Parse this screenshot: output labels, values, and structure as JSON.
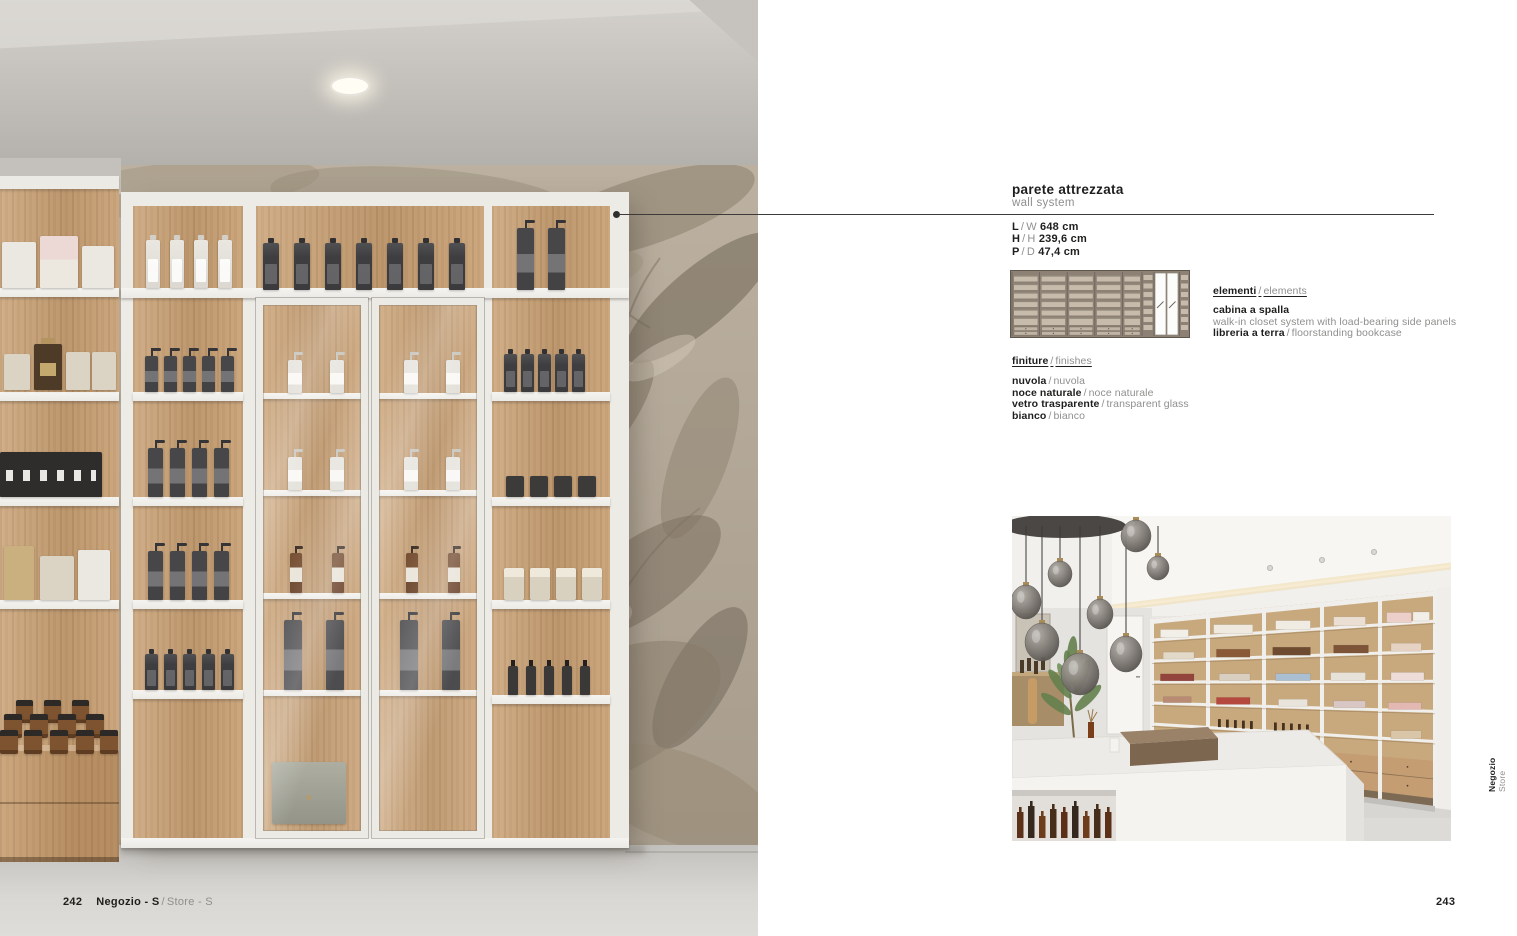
{
  "page": {
    "left_page_number": "242",
    "left_footer_title": "Negozio - S",
    "left_footer_sep": "/",
    "left_footer_subtitle": "Store - S",
    "right_page_number": "243",
    "side_label_bold": "Negozio",
    "side_label_light": "Store"
  },
  "product": {
    "title_it": "parete attrezzata",
    "title_en": "wall system",
    "dimensions": [
      {
        "it": "L",
        "sep": "/",
        "en": "W",
        "value": "648 cm"
      },
      {
        "it": "H",
        "sep": "/",
        "en": "H",
        "value": "239,6 cm"
      },
      {
        "it": "P",
        "sep": "/",
        "en": "D",
        "value": "47,4 cm"
      }
    ],
    "elements": {
      "heading_it": "elementi",
      "heading_sep": "/",
      "heading_en": "elements",
      "items": [
        {
          "name": "cabina a spalla",
          "desc": "walk-in closet system with load-bearing side panels"
        },
        {
          "name": "libreria a terra",
          "sep": "/",
          "desc": "floorstanding bookcase"
        }
      ]
    },
    "finishes": {
      "heading_it": "finiture",
      "heading_sep": "/",
      "heading_en": "finishes",
      "items": [
        {
          "it": "nuvola",
          "sep": "/",
          "en": "nuvola"
        },
        {
          "it": "noce naturale",
          "sep": "/",
          "en": "noce naturale"
        },
        {
          "it": "vetro trasparente",
          "sep": "/",
          "en": "transparent glass"
        },
        {
          "it": "bianco",
          "sep": "/",
          "en": "bianco"
        }
      ]
    }
  },
  "colors": {
    "text_dark": "#1e1e1c",
    "text_light": "#8f8f8d",
    "wood": "#c8a176",
    "unit_white": "#edebe6",
    "wallpaper": "#b2a795",
    "drawing_bg": "#8c8174"
  }
}
